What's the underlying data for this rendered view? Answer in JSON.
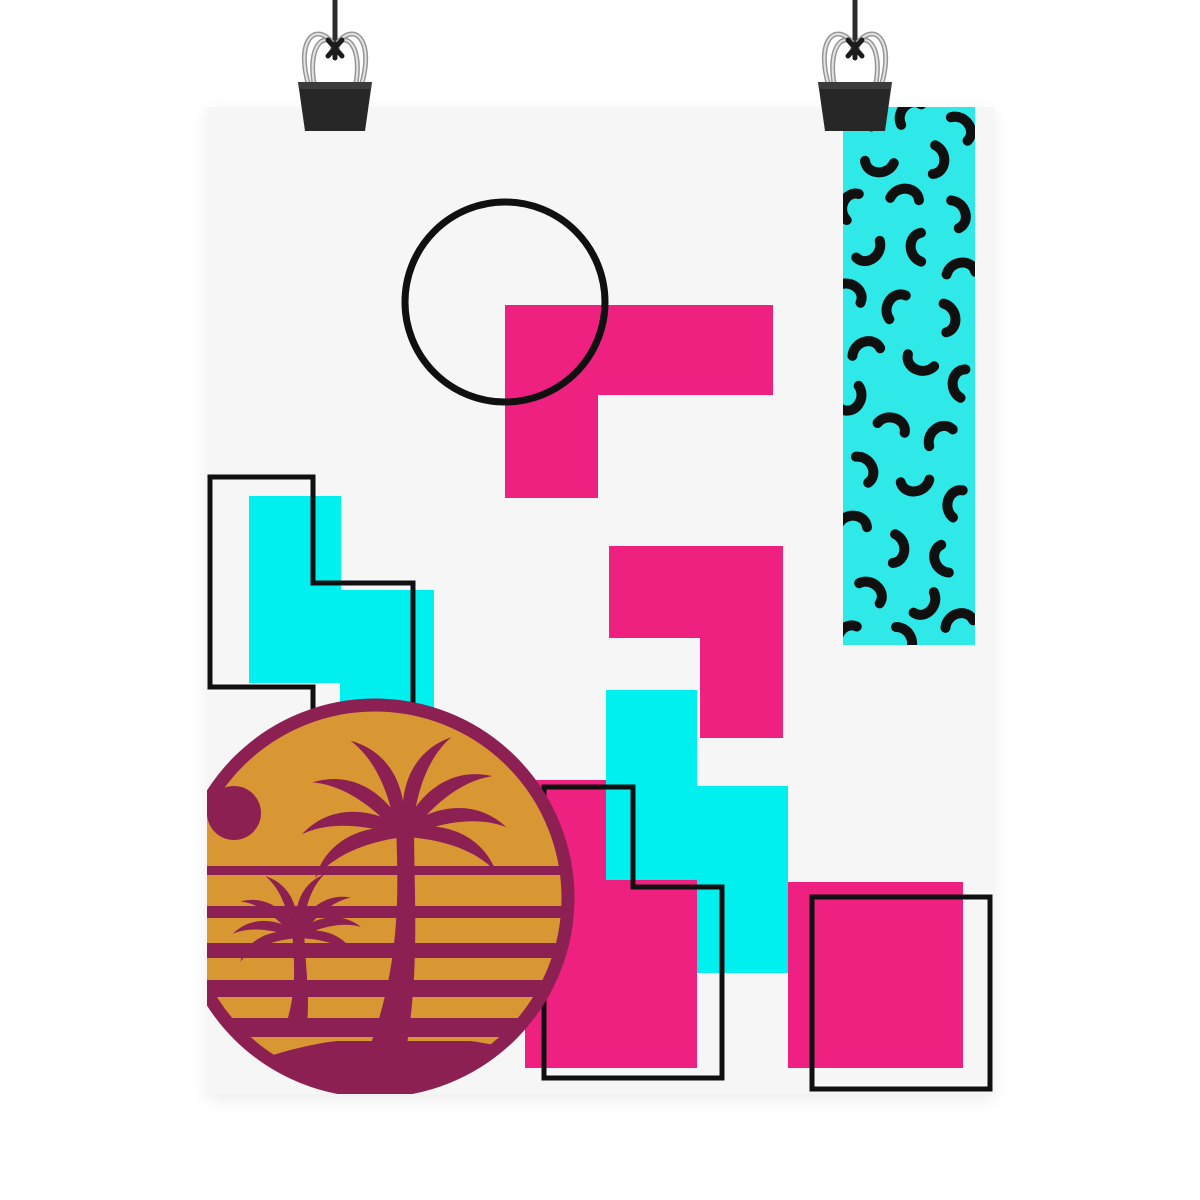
{
  "scene": {
    "description": "Memphis-style geometric art poster hanging from two binder clips",
    "background": "#ffffff",
    "poster": {
      "left": 207,
      "top": 107,
      "width": 787,
      "height": 987,
      "color": "#f5f6f5"
    }
  },
  "palette": {
    "page_bg": "#ffffff",
    "poster_bg": "#f5f6f5",
    "pink": "#ee2180",
    "cyan": "#00efef",
    "teal_panel": "#2ee9e7",
    "maroon": "#8d2053",
    "gold": "#d89733",
    "outline_black": "#101010",
    "clip_body": "#272727",
    "clip_wire": "#e3e3e3",
    "string": "#2d2d2d"
  },
  "art": {
    "viewBox": "0 0 1200 1200",
    "squiggle_path": "M-13,7 C-13,-8 7,-15 14,-3",
    "squiggles": [
      [
        858,
        121,
        35
      ],
      [
        910,
        113,
        -25
      ],
      [
        961,
        128,
        75
      ],
      [
        879,
        164,
        205
      ],
      [
        936,
        160,
        115
      ],
      [
        851,
        206,
        -45
      ],
      [
        905,
        197,
        25
      ],
      [
        957,
        214,
        95
      ],
      [
        869,
        251,
        165
      ],
      [
        919,
        247,
        -70
      ],
      [
        961,
        271,
        15
      ],
      [
        850,
        293,
        55
      ],
      [
        896,
        306,
        -35
      ],
      [
        947,
        318,
        105
      ],
      [
        866,
        350,
        5
      ],
      [
        920,
        362,
        225
      ],
      [
        961,
        383,
        -60
      ],
      [
        852,
        399,
        145
      ],
      [
        892,
        426,
        40
      ],
      [
        940,
        436,
        -15
      ],
      [
        864,
        469,
        85
      ],
      [
        915,
        483,
        195
      ],
      [
        956,
        503,
        -50
      ],
      [
        853,
        524,
        25
      ],
      [
        896,
        549,
        115
      ],
      [
        943,
        559,
        -85
      ],
      [
        871,
        592,
        65
      ],
      [
        925,
        604,
        155
      ],
      [
        959,
        622,
        5
      ],
      [
        847,
        637,
        -35
      ],
      [
        903,
        640,
        90
      ]
    ],
    "elements": [
      {
        "type": "defs",
        "children": [
          {
            "type": "clipPath",
            "id": "posterClip",
            "children": [
              {
                "type": "rect",
                "x": 207,
                "y": 107,
                "width": 787,
                "height": 987
              }
            ]
          },
          {
            "type": "clipPath",
            "id": "tealClip",
            "children": [
              {
                "type": "rect",
                "x": 843,
                "y": 107,
                "width": 132,
                "height": 538
              }
            ]
          },
          {
            "type": "clipPath",
            "id": "sunClip",
            "children": [
              {
                "type": "circle",
                "cx": 375,
                "cy": 898,
                "r": 187
              }
            ]
          },
          {
            "type": "g",
            "id": "binder-clip",
            "name": "binder-clip",
            "children": [
              {
                "type": "path",
                "name": "hanging-string",
                "d": "M0,0 L0,50",
                "stroke": "#2d2d2d",
                "stroke-width": 5,
                "fill": "none"
              },
              {
                "type": "path",
                "name": "clip-wire-outline",
                "d": "M-26,86 C-40,42 -20,18 0,46 M26,86 C40,42 20,18 0,46 M-20,88 C-29,48 -11,26 3,50 M20,88 C29,48 11,26 -3,50",
                "stroke": "#969696",
                "stroke-width": 5,
                "fill": "none"
              },
              {
                "type": "path",
                "name": "clip-wire",
                "d": "M-26,86 C-40,42 -20,18 0,46 M26,86 C40,42 20,18 0,46 M-20,88 C-29,48 -11,26 3,50 M20,88 C29,48 11,26 -3,50",
                "stroke": "#e3e3e3",
                "stroke-width": 2,
                "fill": "none"
              },
              {
                "type": "path",
                "name": "clip-knot",
                "d": "M-7,40 L7,56 M7,40 L-7,56 M0,44 L0,58",
                "stroke": "#1c1c1c",
                "stroke-width": 5,
                "stroke-linecap": "round",
                "fill": "none"
              },
              {
                "type": "path",
                "name": "clip-body",
                "d": "M-37,82 L37,82 L30,131 L-30,131 Z",
                "fill": "#272727"
              },
              {
                "type": "path",
                "name": "clip-body-highlight",
                "d": "M-37,82 L37,82 L36,89 L-36,89 Z",
                "fill": "#3c3c3c"
              }
            ]
          }
        ]
      },
      {
        "type": "g",
        "clip": "posterClip",
        "name": "poster-artwork",
        "children": [
          {
            "type": "rect",
            "name": "poster-sheet",
            "x": 207,
            "y": 107,
            "width": 787,
            "height": 987,
            "fill": "#f5f6f5"
          },
          {
            "type": "g",
            "name": "memphis-squiggle-panel",
            "clip": "tealClip",
            "children": [
              {
                "type": "rect",
                "name": "squiggle-panel-bg",
                "x": 843,
                "y": 107,
                "width": 132,
                "height": 538,
                "fill": "#2ee9e7"
              },
              {
                "type": "squiggle-set"
              }
            ]
          },
          {
            "type": "path",
            "name": "pink-l-shape",
            "d": "M505,305 H773 V395 H598 V498 H505 Z",
            "fill": "#ee2180"
          },
          {
            "type": "circle",
            "name": "outlined-circle",
            "cx": 505,
            "cy": 302,
            "r": 100,
            "fill": "none",
            "stroke": "#101010",
            "stroke-width": 7
          },
          {
            "type": "path",
            "name": "pink-step-shape",
            "d": "M609,546 H783 V738 H700 V638 H609 Z",
            "fill": "#ee2180"
          },
          {
            "type": "rect",
            "name": "pink-rect-bottom-middle",
            "x": 525,
            "y": 780,
            "width": 172,
            "height": 288,
            "fill": "#ee2180"
          },
          {
            "type": "rect",
            "name": "pink-square-bottom-right",
            "x": 788,
            "y": 882,
            "width": 175,
            "height": 186,
            "fill": "#ee2180"
          },
          {
            "type": "path",
            "name": "cyan-s-shape",
            "d": "M606,690 H697 V786 H788 V973 H697 V880 H606 Z",
            "fill": "#00efef"
          },
          {
            "type": "path",
            "name": "cyan-step-left",
            "d": "M249,496 H341 V590 H434 V715 H340 V683 H249 Z",
            "fill": "#00efef"
          },
          {
            "type": "path",
            "name": "black-step-outline-left",
            "d": "M210,477 H313 V583 H413 V765 H313 V687 H210 Z",
            "fill": "none",
            "stroke": "#101010",
            "stroke-width": 5
          },
          {
            "type": "path",
            "name": "black-step-outline-middle",
            "d": "M544,787 H633 V887 H722 V1078 H544 Z",
            "fill": "none",
            "stroke": "#101010",
            "stroke-width": 5
          },
          {
            "type": "rect",
            "name": "black-square-outline",
            "x": 812,
            "y": 897,
            "width": 178,
            "height": 192,
            "fill": "none",
            "stroke": "#101010",
            "stroke-width": 5
          },
          {
            "type": "g",
            "name": "sunset-badge",
            "children": [
              {
                "type": "circle",
                "name": "sun-badge-ring",
                "cx": 375,
                "cy": 898,
                "r": 193,
                "fill": "#d89733",
                "stroke": "#8d2053",
                "stroke-width": 13
              },
              {
                "type": "g",
                "name": "sun-badge-inner",
                "clip": "sunClip",
                "children": [
                  {
                    "type": "circle",
                    "name": "sunset-dot",
                    "cx": 234,
                    "cy": 813,
                    "r": 27,
                    "fill": "#8d2053"
                  },
                  {
                    "type": "rect",
                    "name": "sunset-stripe",
                    "x": 175,
                    "y": 866,
                    "width": 405,
                    "height": 9,
                    "fill": "#8d2053"
                  },
                  {
                    "type": "rect",
                    "name": "sunset-stripe",
                    "x": 175,
                    "y": 906,
                    "width": 405,
                    "height": 12,
                    "fill": "#8d2053"
                  },
                  {
                    "type": "rect",
                    "name": "sunset-stripe",
                    "x": 175,
                    "y": 943,
                    "width": 405,
                    "height": 15,
                    "fill": "#8d2053"
                  },
                  {
                    "type": "rect",
                    "name": "sunset-stripe",
                    "x": 175,
                    "y": 980,
                    "width": 405,
                    "height": 17,
                    "fill": "#8d2053"
                  },
                  {
                    "type": "rect",
                    "name": "sunset-stripe",
                    "x": 175,
                    "y": 1018,
                    "width": 405,
                    "height": 19,
                    "fill": "#8d2053"
                  },
                  {
                    "type": "rect",
                    "name": "sunset-stripe",
                    "x": 175,
                    "y": 1056,
                    "width": 405,
                    "height": 22,
                    "fill": "#8d2053"
                  },
                  {
                    "type": "path",
                    "name": "beach-ground",
                    "d": "M170,1100 C240,1060 302,1045 337,1041 L470,1041 C520,1047 556,1066 590,1100 Z",
                    "fill": "#8d2053"
                  },
                  {
                    "type": "g",
                    "name": "palm-tree-small",
                    "transform": "translate(297 932)",
                    "children": [
                      {
                        "type": "path",
                        "name": "palm-trunk",
                        "d": "M-5,-4 C-3,30 1,60 -13,98 L9,101 C14,66 8,32 7,-4 Z",
                        "fill": "#8d2053"
                      },
                      {
                        "type": "path",
                        "name": "palm-frond",
                        "transform": "rotate(-32)",
                        "d": "M0,0 C-19,-16 -44,-21 -64,-5 C-44,-11 -20,-4 0,7 Z",
                        "fill": "#8d2053"
                      },
                      {
                        "type": "path",
                        "name": "palm-frond",
                        "transform": "rotate(-6)",
                        "d": "M0,0 C-19,-16 -44,-21 -64,-5 C-44,-11 -20,-4 0,7 Z",
                        "fill": "#8d2053"
                      },
                      {
                        "type": "path",
                        "name": "palm-frond",
                        "transform": "rotate(24)",
                        "d": "M0,0 C-19,-16 -44,-21 -64,-5 C-44,-11 -20,-4 0,7 Z",
                        "fill": "#8d2053"
                      },
                      {
                        "type": "path",
                        "name": "palm-frond",
                        "transform": "rotate(56)",
                        "d": "M0,0 C-19,-16 -44,-21 -64,-5 C-44,-11 -20,-4 0,7 Z",
                        "fill": "#8d2053"
                      },
                      {
                        "type": "path",
                        "name": "palm-frond",
                        "transform": "scale(-1 1) rotate(-28)",
                        "d": "M0,0 C-19,-16 -44,-21 -64,-5 C-44,-11 -20,-4 0,7 Z",
                        "fill": "#8d2053"
                      },
                      {
                        "type": "path",
                        "name": "palm-frond",
                        "transform": "scale(-1 1) rotate(0)",
                        "d": "M0,0 C-19,-16 -44,-21 -64,-5 C-44,-11 -20,-4 0,7 Z",
                        "fill": "#8d2053"
                      },
                      {
                        "type": "path",
                        "name": "palm-frond",
                        "transform": "scale(-1 1) rotate(28)",
                        "d": "M0,0 C-19,-16 -44,-21 -64,-5 C-44,-11 -20,-4 0,7 Z",
                        "fill": "#8d2053"
                      },
                      {
                        "type": "path",
                        "name": "palm-frond",
                        "transform": "scale(-1 1) rotate(60)",
                        "d": "M0,0 C-19,-16 -44,-21 -64,-5 C-44,-11 -20,-4 0,7 Z",
                        "fill": "#8d2053"
                      }
                    ]
                  },
                  {
                    "type": "g",
                    "name": "palm-tree-large",
                    "transform": "translate(404 828)",
                    "children": [
                      {
                        "type": "path",
                        "name": "palm-trunk",
                        "d": "M-8,-6 C-6,60 -2,130 -34,218 L2,222 C16,140 10,70 10,-6 Z",
                        "fill": "#8d2053"
                      },
                      {
                        "type": "path",
                        "name": "palm-frond",
                        "transform": "rotate(-34)",
                        "d": "M0,0 C-30,-26 -70,-34 -102,-8 C-70,-18 -32,-7 0,10 Z",
                        "fill": "#8d2053"
                      },
                      {
                        "type": "path",
                        "name": "palm-frond",
                        "transform": "rotate(-8)",
                        "d": "M0,0 C-30,-26 -70,-34 -102,-8 C-70,-18 -32,-7 0,10 Z",
                        "fill": "#8d2053"
                      },
                      {
                        "type": "path",
                        "name": "palm-frond",
                        "transform": "rotate(22)",
                        "d": "M0,0 C-30,-26 -70,-34 -102,-8 C-70,-18 -32,-7 0,10 Z",
                        "fill": "#8d2053"
                      },
                      {
                        "type": "path",
                        "name": "palm-frond",
                        "transform": "rotate(54)",
                        "d": "M0,0 C-30,-26 -70,-34 -102,-8 C-70,-18 -32,-7 0,10 Z",
                        "fill": "#8d2053"
                      },
                      {
                        "type": "path",
                        "name": "palm-frond",
                        "transform": "scale(-1 1) rotate(-30)",
                        "d": "M0,0 C-30,-26 -70,-34 -102,-8 C-70,-18 -32,-7 0,10 Z",
                        "fill": "#8d2053"
                      },
                      {
                        "type": "path",
                        "name": "palm-frond",
                        "transform": "scale(-1 1) rotate(-4)",
                        "d": "M0,0 C-30,-26 -70,-34 -102,-8 C-70,-18 -32,-7 0,10 Z",
                        "fill": "#8d2053"
                      },
                      {
                        "type": "path",
                        "name": "palm-frond",
                        "transform": "scale(-1 1) rotate(26)",
                        "d": "M0,0 C-30,-26 -70,-34 -102,-8 C-70,-18 -32,-7 0,10 Z",
                        "fill": "#8d2053"
                      },
                      {
                        "type": "path",
                        "name": "palm-frond",
                        "transform": "scale(-1 1) rotate(58)",
                        "d": "M0,0 C-30,-26 -70,-34 -102,-8 C-70,-18 -32,-7 0,10 Z",
                        "fill": "#8d2053"
                      }
                    ]
                  }
                ]
              }
            ]
          }
        ]
      },
      {
        "type": "use",
        "name": "binder-clip-left",
        "href": "#binder-clip",
        "transform": "translate(335 0)"
      },
      {
        "type": "use",
        "name": "binder-clip-right",
        "href": "#binder-clip",
        "transform": "translate(855 0)"
      }
    ]
  }
}
